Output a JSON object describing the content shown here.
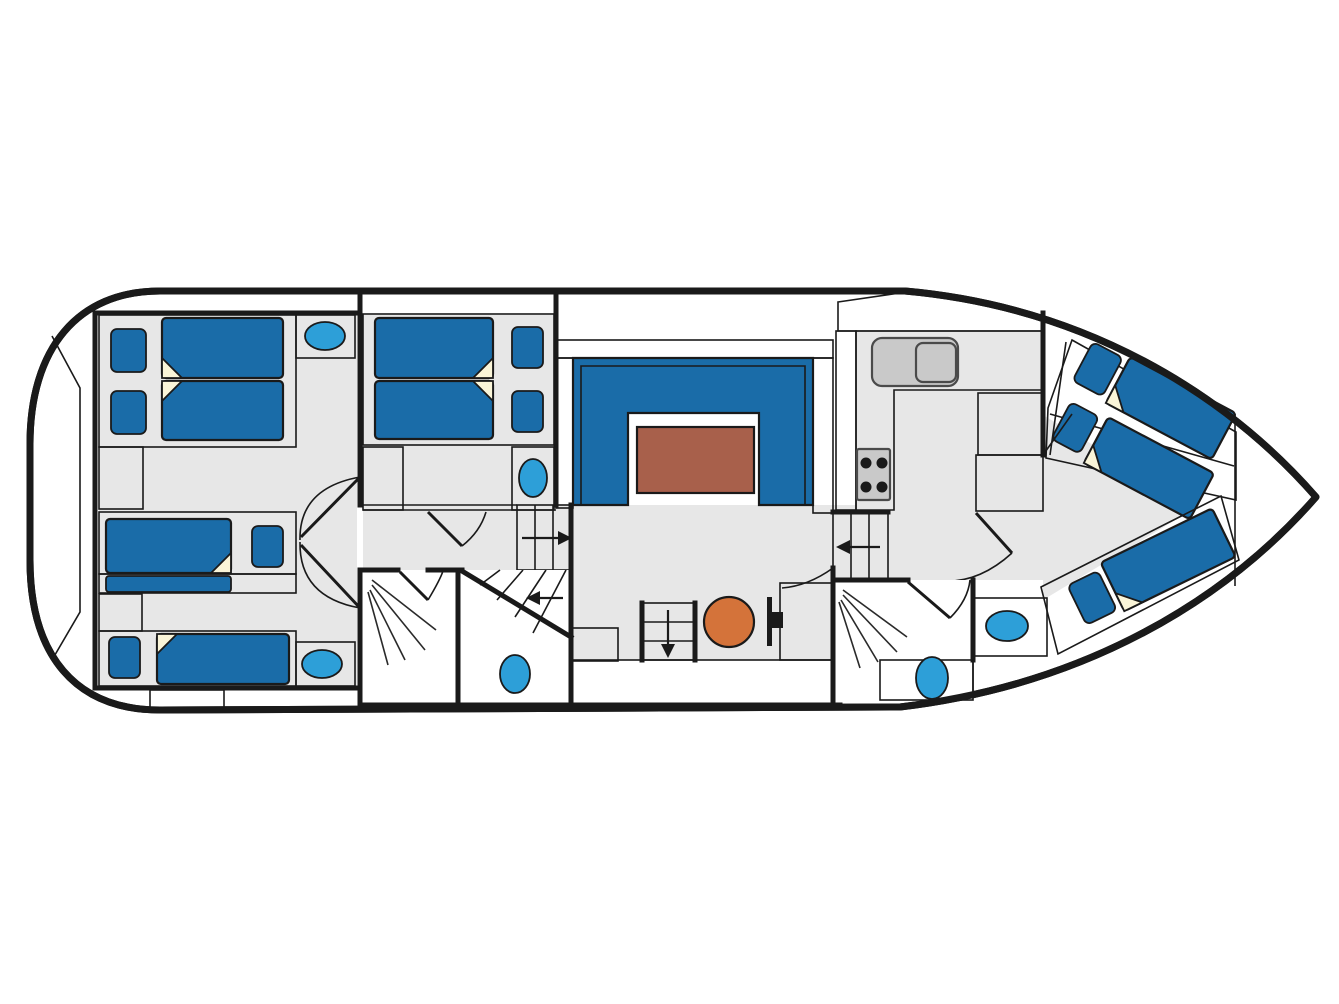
{
  "title": "Motor cruiser deck plan (top view, bow right)",
  "palette": {
    "wall": "#1a1a1a",
    "deck": "#ffffff",
    "floor": "#e7e7e7",
    "platform": "#faf5d8",
    "mattress": "#1a6ca8",
    "pillow": "#1a6ca8",
    "fixture": "#2d9fd8",
    "cabinet": "#a55c41",
    "trim": "#d79a5f",
    "counter": "#f6d7a9",
    "table": "#a8604b",
    "seat": "#d4733a",
    "appliance": "#c9c9c9",
    "burner": "#1a1a1a",
    "arrow": "#1a1a1a",
    "room_white": "#ffffff"
  },
  "icons": {
    "washbasin": "small blue oval",
    "toilet": "blue oval on plinth",
    "shower": "fan of spray lines",
    "stove": "grey hob with 4 burners",
    "kitchen_sink": "grey rounded double bowl",
    "helm_seat": "orange circle",
    "helm_console": "black bar with knob",
    "direction_arrow": "black arrow on stairs",
    "door": "leaf line with swing arc",
    "bed": "blue mattress with folded corner and pillow on cream berth"
  },
  "rooms": [
    "aft deck",
    "aft cabin port",
    "aft cabin starboard",
    "aft shower room",
    "aft toilet room",
    "mid cabin",
    "saloon with U-sofa and table",
    "galley",
    "helm area",
    "bow shower room",
    "bow washroom",
    "bow cabin with three berths",
    "foredeck"
  ]
}
